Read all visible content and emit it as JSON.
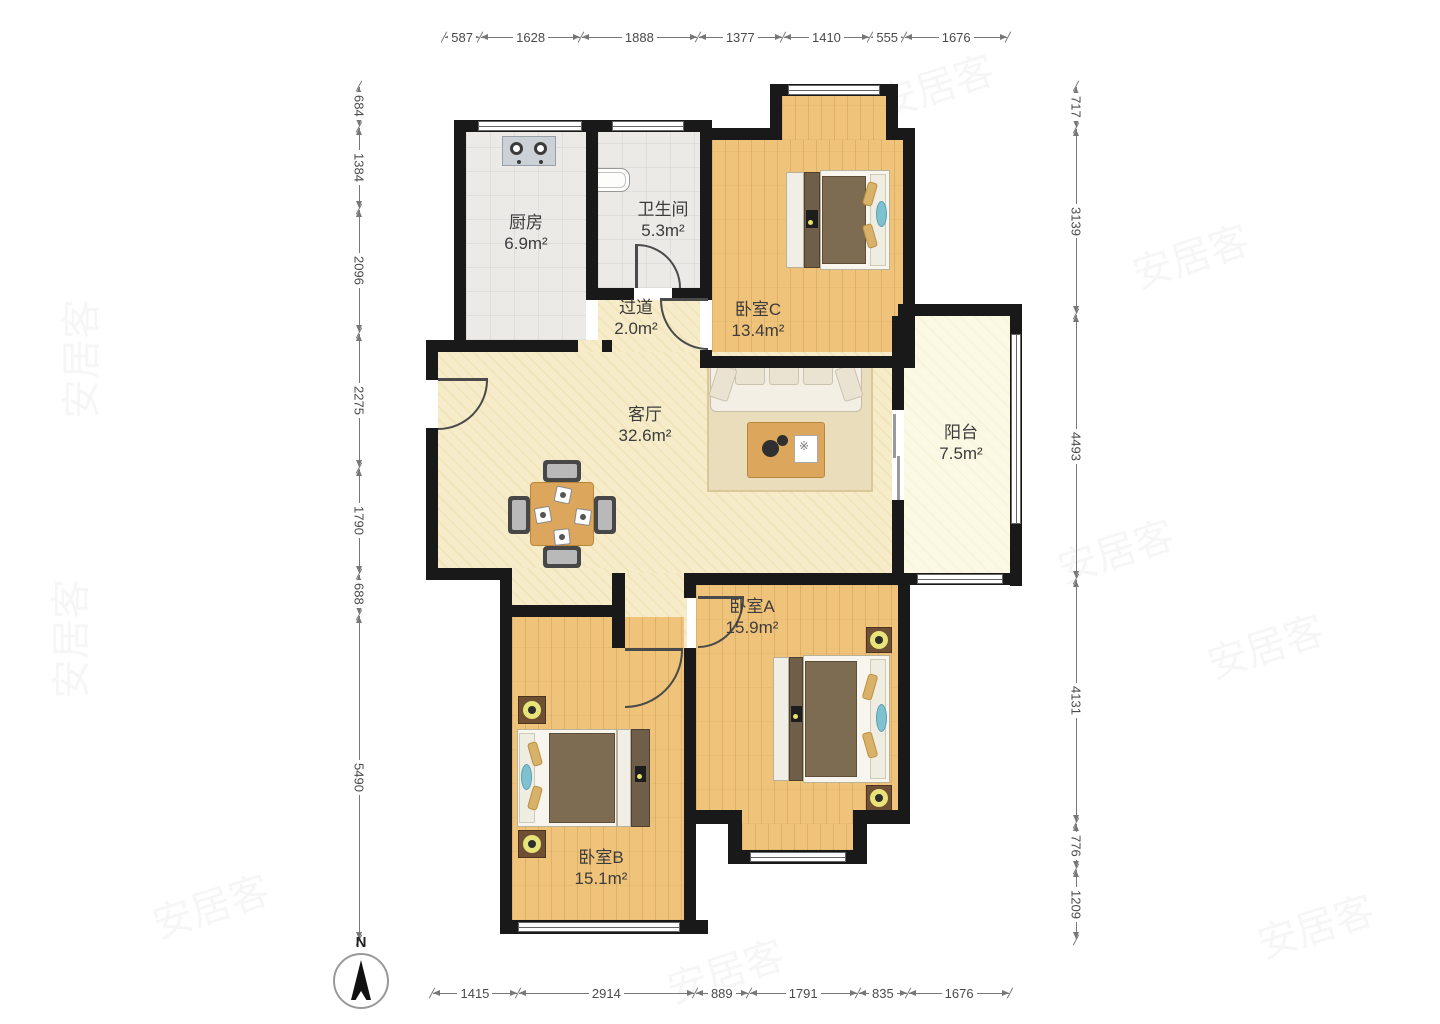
{
  "floor_plan": {
    "compass": {
      "label": "N"
    },
    "watermark_text": "安居客",
    "rooms": [
      {
        "key": "kitchen",
        "name": "厨房",
        "area": "6.9m²"
      },
      {
        "key": "bathroom",
        "name": "卫生间",
        "area": "5.3m²"
      },
      {
        "key": "hallway",
        "name": "过道",
        "area": "2.0m²"
      },
      {
        "key": "bedroom-c",
        "name": "卧室C",
        "area": "13.4m²"
      },
      {
        "key": "living",
        "name": "客厅",
        "area": "32.6m²"
      },
      {
        "key": "balcony",
        "name": "阳台",
        "area": "7.5m²"
      },
      {
        "key": "bedroom-a",
        "name": "卧室A",
        "area": "15.9m²"
      },
      {
        "key": "bedroom-b",
        "name": "卧室B",
        "area": "15.1m²"
      }
    ],
    "dimensions_mm": {
      "top": [
        587,
        1628,
        1888,
        1377,
        1410,
        555,
        1676
      ],
      "bottom": [
        1415,
        2914,
        889,
        1791,
        835,
        1676
      ],
      "left": [
        684,
        1384,
        2096,
        2275,
        1790,
        688,
        5490
      ],
      "right": [
        717,
        3139,
        4493,
        4131,
        776,
        1209
      ]
    },
    "colors": {
      "wall": "#191919",
      "wood_floor": "#efc379",
      "living_floor": "#f6ecc9",
      "tile_floor": "#eceae7",
      "balcony_floor": "#fbf8e4"
    }
  }
}
